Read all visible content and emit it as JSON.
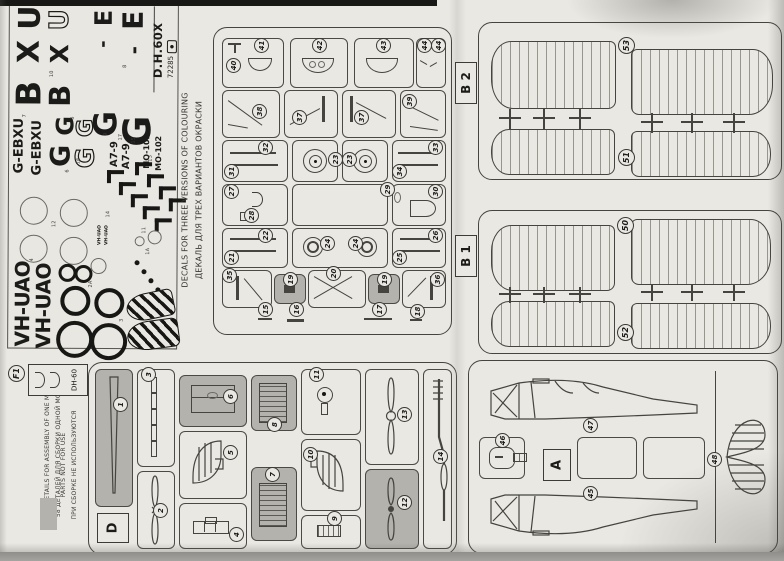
{
  "corner": {
    "model": "D.H.60X",
    "code": "72285"
  },
  "notes": {
    "decals_en": "DECALS FOR THREE VERSIONS OF COLOURING",
    "decals_ru": "ДЕКАЛЬ ДЛЯ ТРЕХ ВАРИАНТОВ ОКРАСКИ",
    "details_en": "58 DETAILS FOR ASSEMBLY OF ONE MODEL",
    "details_ru": "58 ДЕТАЛЕЙ ДЛЯ СБОРКИ ОДНОЙ МОДЕЛИ",
    "not_for_use_en": "PARTS NOT FOR USE",
    "not_for_use_ru": "ПРИ СБОРКЕ НЕ ИСПОЛЬЗУЮТСЯ"
  },
  "decals": {
    "letters": {
      "u1": "U",
      "u2": "U",
      "x1": "X",
      "x2": "X",
      "b1": "B",
      "b2": "B",
      "e1": "E",
      "e2": "E",
      "dash1": "-",
      "dash2": "-",
      "g_e1": "G",
      "g_e2": "G",
      "g1": "G",
      "g2": "G",
      "g3": "G",
      "g4": "G"
    },
    "regs": {
      "r1": "G-EBXU",
      "r2": "G-EBXU",
      "v1": "VH-UAO",
      "v2": "VH-UAO",
      "t1": "VH-UAO",
      "t2": "VH-UAO"
    },
    "codes": {
      "a1": "A7-9",
      "a2": "A7-9",
      "m1": "MO-102",
      "m2": "MO-102"
    },
    "idx": {
      "n1": "1",
      "n1a": "1A",
      "n2": "2",
      "n2a": "2A",
      "n3": "3",
      "n4": "4",
      "n5": "5",
      "n6": "6",
      "n7": "7",
      "n8": "8",
      "n9": "9",
      "n10": "10",
      "n11": "11",
      "n12": "12",
      "n13": "13",
      "n14": "14",
      "n15": "15",
      "n16": "16",
      "n17": "17",
      "L": "L",
      "R": "R"
    }
  },
  "sprues": {
    "b2": {
      "label": "B 2",
      "top": "53",
      "bottom": "51"
    },
    "b1": {
      "label": "B 1",
      "top": "50",
      "bottom": "52"
    },
    "a": {
      "label": "A",
      "n45": "45",
      "n46": "46",
      "n47": "47",
      "n48": "48"
    },
    "d": {
      "label": "D",
      "n1": "1",
      "n2": "2",
      "n3": "3",
      "n4": "4",
      "n5": "5",
      "n6": "6",
      "n7": "7",
      "n8": "8",
      "n9": "9",
      "n10": "10",
      "n11": "11",
      "n12": "12",
      "n13": "13",
      "n14": "14"
    },
    "c": {
      "n15": "15",
      "n16": "16",
      "n17": "17",
      "n18": "18",
      "n19a": "19",
      "n19b": "19",
      "n20": "20",
      "n21": "21",
      "n22": "22",
      "n23a": "23",
      "n23b": "23",
      "n24a": "24",
      "n24b": "24",
      "n25": "25",
      "n26": "26",
      "n27": "27",
      "n28": "28",
      "n29": "29",
      "n30": "30",
      "n31": "31",
      "n32": "32",
      "n33": "33",
      "n34": "34",
      "n35": "35",
      "n36": "36",
      "n37a": "37",
      "n37b": "37",
      "n38": "38",
      "n39": "39",
      "n40": "40",
      "n41": "41",
      "n42": "42",
      "n43": "43",
      "n44a": "44",
      "n44b": "44"
    },
    "f": {
      "badge": "F1",
      "label": "DH-60"
    }
  }
}
